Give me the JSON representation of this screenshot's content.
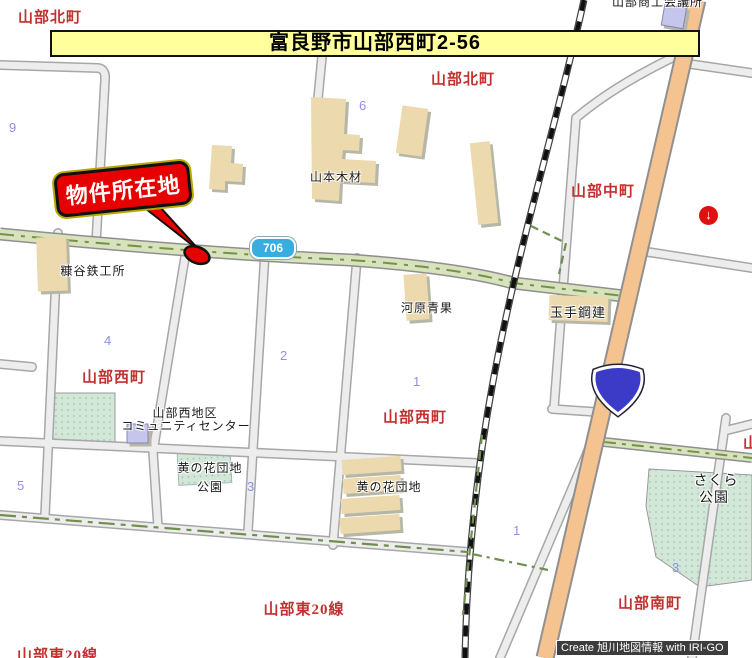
{
  "banner": {
    "address": "富良野市山部西町2-56"
  },
  "callout": {
    "label": "物件所在地"
  },
  "shields": {
    "prefectural_route": "706",
    "national_route": "38"
  },
  "districts": {
    "kitamachi_left": "山部北町",
    "kitamachi_center": "山部北町",
    "nakamachi": "山部中町",
    "nishimachi_west": "山部西町",
    "nishimachi_center": "山部西町",
    "minamimachi": "山部南町",
    "higashi20sen_center": "山部東20線",
    "higashi20sen_corner": "山部東20線",
    "clipped_right": "山"
  },
  "pois": {
    "clipped_top": "山部商工会議所",
    "yamamoto_mokuzai": "山本木材",
    "nukaya_tekkosho": "糠谷鉄工所",
    "kawahara_seika": "河原青果",
    "tamate_kouken": "玉手鋼建",
    "community_center_line1": "山部西地区",
    "community_center_line2": "コミュニティセンター",
    "kinohana_park_line1": "黄の花団地",
    "kinohana_park_line2": "公園",
    "kinohana_danchi": "黄の花団地",
    "sakura_park_line1": "さくら",
    "sakura_park_line2": "公園"
  },
  "block_numbers": [
    "9",
    "6",
    "4",
    "2",
    "1",
    "1",
    "3",
    "5",
    "3"
  ],
  "credit": {
    "text": "Create 旭川地図情報 with IRI-GO"
  },
  "colors": {
    "banner_bg": "#ffff9c",
    "callout_red": "#e60000",
    "district_red": "#c23030",
    "number_blue": "#8f8fe8",
    "shield706_blue": "#38ade0",
    "shield38_blue": "#3b3bc8",
    "route706_fill": "#d8e2bc",
    "route38_fill": "#f4c390",
    "park_fill": "#d3e7d9",
    "building_tan": "#ecd9ae",
    "building_purple": "#c6c6ec",
    "credit_bg": "#3c3c3c"
  }
}
